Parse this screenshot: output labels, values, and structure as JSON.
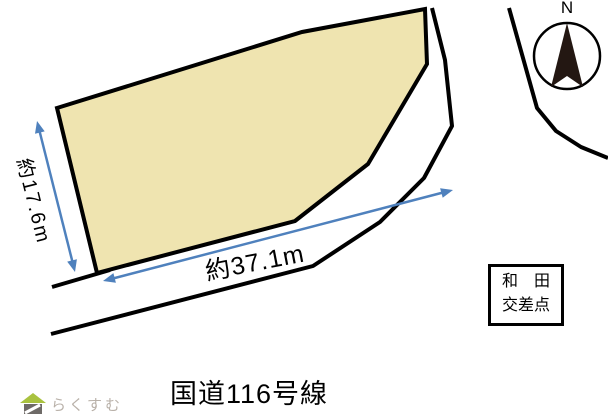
{
  "diagram": {
    "dimensions": {
      "left_edge": "約17.6m",
      "bottom_edge": "約37.1m"
    },
    "road_name": "国道116号線",
    "intersection_box": {
      "line1": "和　田",
      "line2": "交差点"
    },
    "compass": {
      "north_label": "N"
    },
    "logo": {
      "text": "らくすむ"
    }
  },
  "icons": {
    "compass_needle": "north-arrow-icon",
    "logo_mark": "house-icon"
  },
  "colors": {
    "parcel_fill": "#EFE4B0",
    "outline": "#000000",
    "dimension_arrow": "#4F81BD",
    "compass_needle": "#231712",
    "logo_roof": "#A9C23F",
    "logo_house": "#6E6A67",
    "logo_text": "#B9B1A9"
  }
}
